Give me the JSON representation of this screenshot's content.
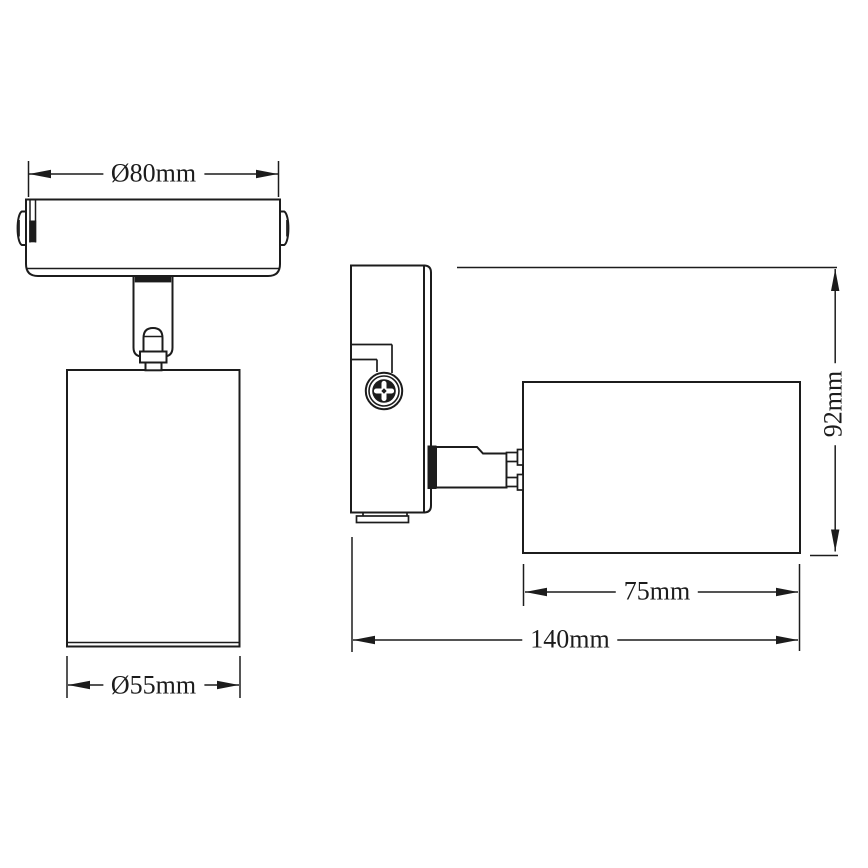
{
  "drawing": {
    "background_color": "#ffffff",
    "line_color": "#1c1c1c",
    "views": {
      "front": {
        "dimensions": {
          "plate_diameter": "Ø80mm",
          "body_diameter": "Ø55mm"
        }
      },
      "side": {
        "dimensions": {
          "height": "92mm",
          "body_length": "75mm",
          "total_depth": "140mm"
        }
      }
    }
  }
}
